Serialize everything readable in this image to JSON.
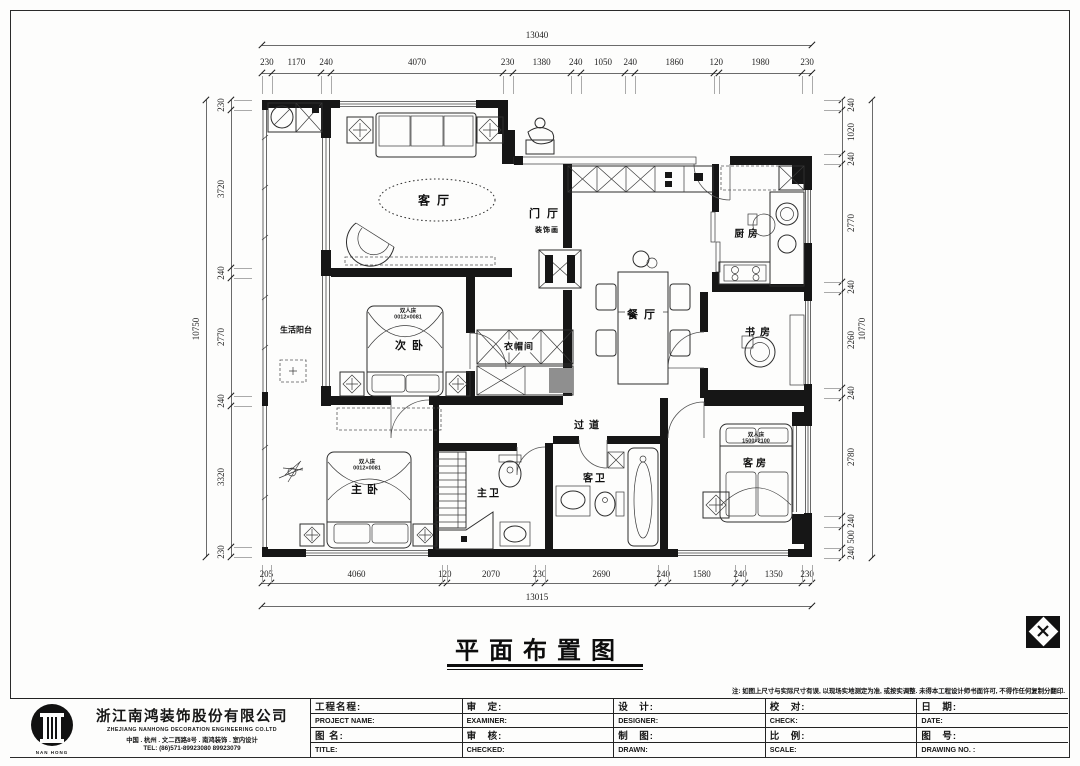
{
  "sheet": {
    "title": "平面布置图",
    "note": "注: 如图上尺寸与实际尺寸有误, 以现场实地测定为准, 或按实调整. 未得本工程设计师书面许可, 不得作任何复制分翻印."
  },
  "company": {
    "name_cn": "浙江南鸿装饰股份有限公司",
    "name_en": "ZHEJIANG NANHONG DECORATION ENGINEERING CO.LTD",
    "address": "中国 . 杭州 . 文二西路8号 . 南鸿装饰 . 室内设计",
    "tel": "TEL:    (86)571-89923080   89923079",
    "logo_text": "NAN HONG"
  },
  "titleblock": {
    "cols": [
      {
        "r1cn": "工程名程:",
        "r1en": "PROJECT NAME:",
        "r2cn": "图 名:",
        "r2en": "TITLE:"
      },
      {
        "r1cn": "审　定:",
        "r1en": "EXAMINER:",
        "r2cn": "审　核:",
        "r2en": "CHECKED:"
      },
      {
        "r1cn": "设　计:",
        "r1en": "DESIGNER:",
        "r2cn": "制　图:",
        "r2en": "DRAWN:"
      },
      {
        "r1cn": "校　对:",
        "r1en": "CHECK:",
        "r2cn": "比　例:",
        "r2en": "SCALE:"
      },
      {
        "r1cn": "日　期:",
        "r1en": "DATE:",
        "r2cn": "图　号:",
        "r2en": "DRAWING NO. :"
      }
    ]
  },
  "rooms": {
    "living": "客厅",
    "foyer": "门厅",
    "deco": "装饰画",
    "kitchen": "厨房",
    "dining": "餐厅",
    "study": "书房",
    "balcony": "生活阳台",
    "bedroom2": "次卧",
    "cloakroom": "衣帽间",
    "corridor": "过道",
    "master": "主卧",
    "master_bath": "主卫",
    "guest_bath": "客卫",
    "guest": "客房"
  },
  "furniture": {
    "double_bed": "双人床",
    "bed_size_flipped": "0012×0081",
    "guest_bed_size": "1500×2100"
  },
  "dims": {
    "top": {
      "total": "13040",
      "segments": [
        "230",
        "1170",
        "240",
        "4070",
        "230",
        "1380",
        "240",
        "1050",
        "240",
        "1860",
        "120",
        "1980",
        "230"
      ]
    },
    "bottom": {
      "total": "13015",
      "segments": [
        "205",
        "4060",
        "120",
        "2070",
        "230",
        "2690",
        "240",
        "1580",
        "240",
        "1350",
        "230"
      ]
    },
    "left": {
      "total": "10750",
      "segments": [
        "230",
        "3720",
        "240",
        "2770",
        "240",
        "3320",
        "230"
      ]
    },
    "right": {
      "total": "10770",
      "segments": [
        "240",
        "1020",
        "240",
        "2770",
        "240",
        "2260",
        "240",
        "2780",
        "240",
        "500",
        "240"
      ]
    }
  },
  "colors": {
    "wall": "#161616",
    "dimline": "#6b6b6b",
    "paper": "#fdfdfc"
  }
}
